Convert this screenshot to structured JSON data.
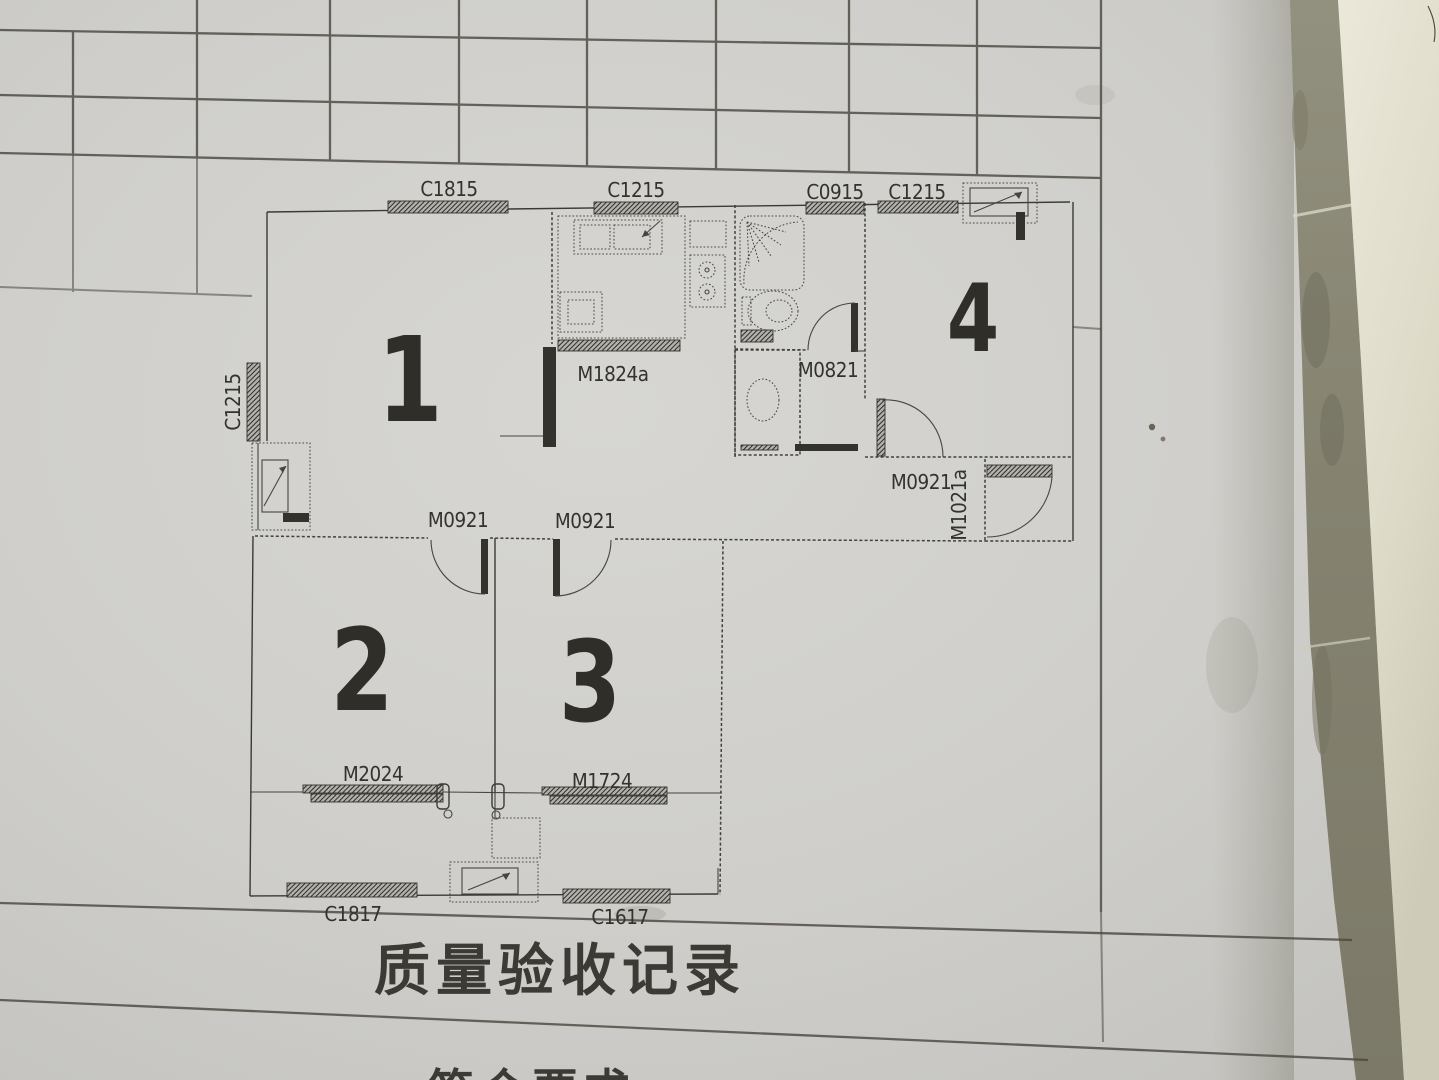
{
  "page": {
    "title_row": "质量验收记录",
    "bottom_row_partial": "符合要求"
  },
  "floor_plan": {
    "rooms": {
      "r1": "1",
      "r2": "2",
      "r3": "3",
      "r4": "4"
    },
    "windows": {
      "c1815_top": "C1815",
      "c1215_kitchen": "C1215",
      "c0915_bath": "C0915",
      "c1215_room4": "C1215",
      "c1215_left": "C1215",
      "c1817_bottom_left": "C1817",
      "c1617_bottom_right": "C1617"
    },
    "doors": {
      "m1824a_kitchen": "M1824a",
      "m0821_bath": "M0821",
      "m0921_room2": "M0921",
      "m0921_room3": "M0921",
      "m0921_room4": "M0921",
      "m1021a_entry": "M1021a",
      "m2024_balcony": "M2024",
      "m1724_balcony": "M1724"
    }
  }
}
